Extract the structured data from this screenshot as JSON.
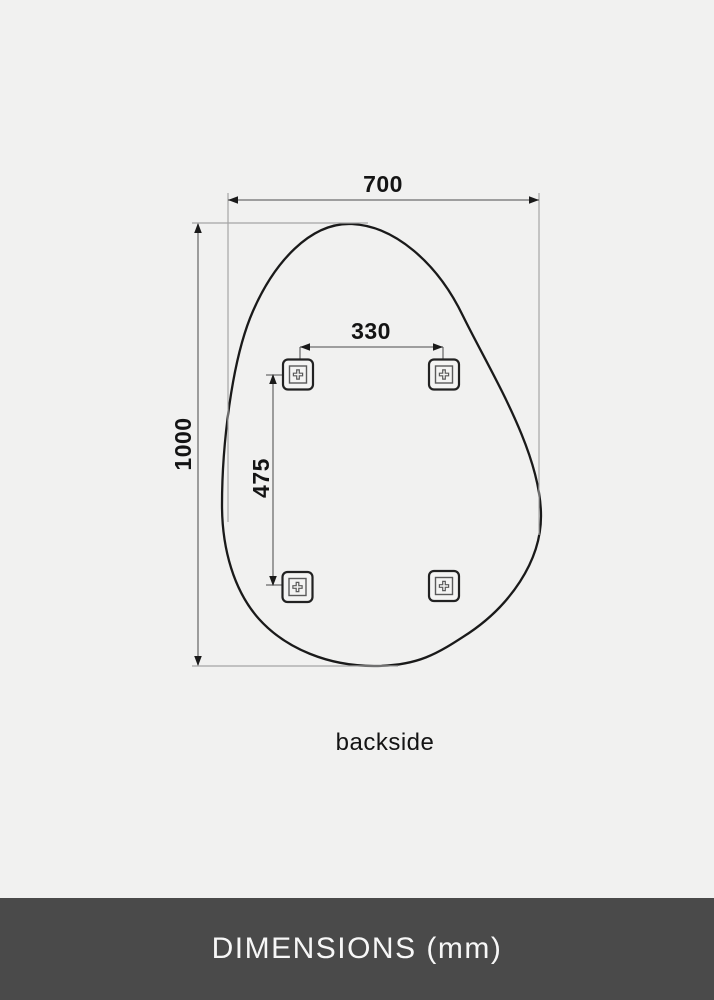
{
  "app": {
    "background_color": "#f1f1f0",
    "line_color": "#1a1a1a",
    "dimension_line_color": "#6e6e6e",
    "extension_line_color": "#a5a5a5"
  },
  "diagram": {
    "subject": "mirror-backside-dimension-drawing",
    "caption": "backside",
    "dimensions": {
      "overall_width_mm": "700",
      "overall_height_mm": "1000",
      "bracket_span_horizontal_mm": "330",
      "bracket_span_vertical_mm": "475"
    },
    "mount_brackets": {
      "count": 4,
      "icon": "mounting-bracket-screw-cross-icon"
    }
  },
  "footer": {
    "label": "DIMENSIONS (mm)",
    "background_color": "#4a4a4a",
    "text_color": "#f7f7f7"
  }
}
